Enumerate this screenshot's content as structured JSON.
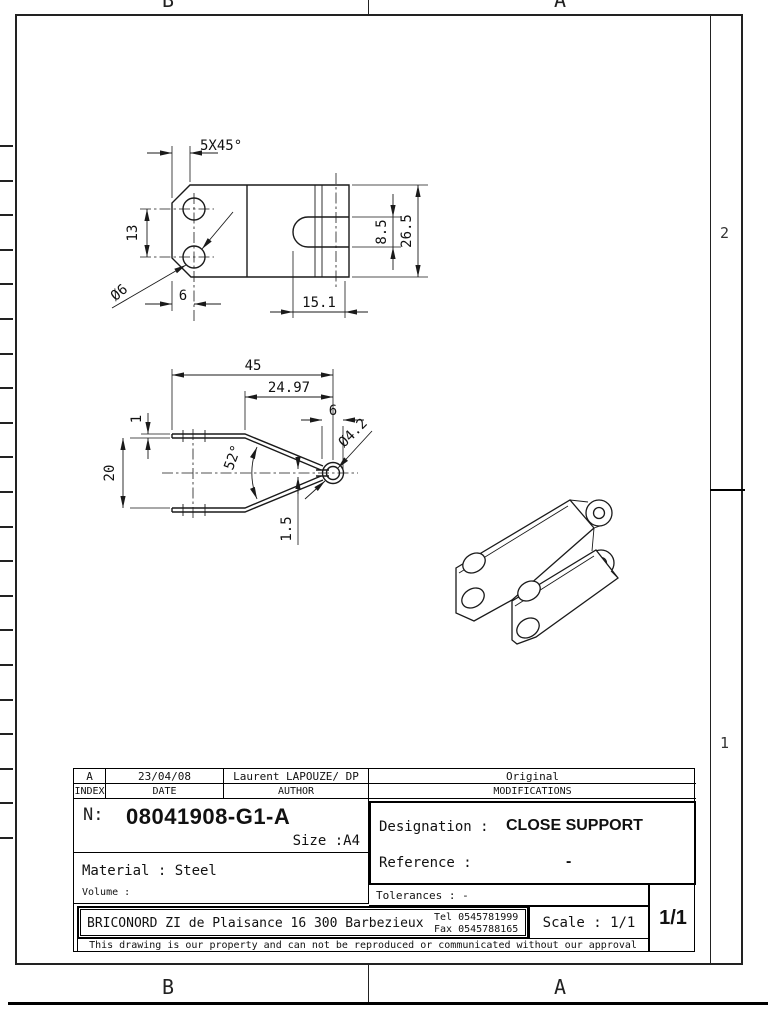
{
  "sheet": {
    "zone_letters_top": [
      "B",
      "A"
    ],
    "zone_letters_bottom": [
      "B",
      "A"
    ],
    "zone_numbers_right": [
      "2",
      "1"
    ]
  },
  "dims": {
    "chamfer": "5X45°",
    "hole_pitch": "13",
    "hole_dia": "Ø6",
    "hole_edge_offset": "6",
    "slot_depth": "15.1",
    "slot_width": "8.5",
    "plate_width": "26.5",
    "overall_length": "45",
    "taper_length": "24.97",
    "loop_outer": "6",
    "thickness": "1",
    "jaw_opening": "20",
    "angle": "52°",
    "loop_dia": "Ø4.2",
    "slot_gap": "1.5"
  },
  "title_block": {
    "index_value": "A",
    "date_value": "23/04/08",
    "author_value": "Laurent LAPOUZE/ DP",
    "modifications_value": "Original",
    "index_label": "INDEX",
    "date_label": "DATE",
    "author_label": "AUTHOR",
    "modifications_label": "MODIFICATIONS",
    "number_label": "N:",
    "number": "08041908-G1-A",
    "size": "Size :A4",
    "material": "Material : Steel",
    "volume_label": "Volume :",
    "designation_label": "Designation :",
    "designation": "CLOSE SUPPORT",
    "reference_label": "Reference :",
    "reference_value": "-",
    "tolerances": "Tolerances : -",
    "company_address": "BRICONORD ZI de Plaisance 16 300 Barbezieux",
    "tel": "Tel 0545781999",
    "fax": "Fax 0545788165",
    "scale": "Scale : 1/1",
    "sheet_number": "1/1",
    "disclaimer": "This drawing is our property and can not be reproduced or communicated without our approval"
  }
}
